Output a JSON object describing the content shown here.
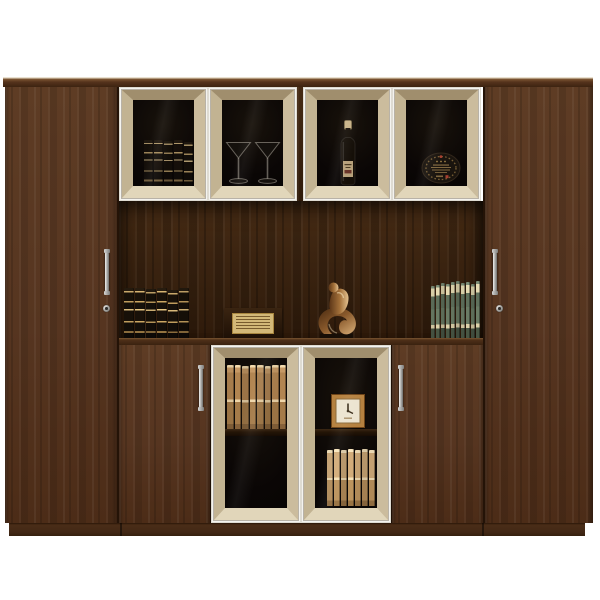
{
  "image": {
    "type": "furniture product photograph",
    "subject": "dark walnut office wall cabinet with champagne-framed glass display doors",
    "background": "#ffffff"
  },
  "colors": {
    "wood": "#573620",
    "wood_dark_interior": "#38220f",
    "frame_champagne": "#c9ba9b",
    "frame_white_edge": "#f4f3ef",
    "glass_black": "#070403",
    "plinth": "#432816",
    "handle_silver": "#c9c9c7",
    "bronze_figurine": "#8a5a2c",
    "clock_frame": "#b5813f",
    "gold_book_band": "#c9a86a",
    "green_book": "#5a6a56",
    "tan_book": "#a67c4c"
  },
  "cabinet": {
    "left_side_cabinet": {
      "title": "tall wooden cabinet door with silver handle and keyhole"
    },
    "right_side_cabinet": {
      "title": "tall wooden cabinet door with silver handle and keyhole"
    },
    "top_display_doors": [
      {
        "title": "glass door with gold-banded encyclopedias"
      },
      {
        "title": "glass door with two martini glasses"
      },
      {
        "title": "glass door with wine bottle"
      },
      {
        "title": "glass door with commemorative plate"
      }
    ],
    "open_shelf_items": [
      {
        "title": "set of gold-banded encyclopedias"
      },
      {
        "title": "framed certificate plaque"
      },
      {
        "title": "bronze abstract figurine"
      },
      {
        "title": "row of green paperback volumes"
      }
    ],
    "bottom_row": {
      "left_wood_door": {
        "title": "wooden door with silver handle"
      },
      "left_glass_door": {
        "title": "glass door with tan books on upper shelf"
      },
      "right_glass_door": {
        "title": "glass door with wooden clock and tan books"
      },
      "right_wood_door": {
        "title": "wooden door with silver handle"
      }
    }
  },
  "books": {
    "display_top_left": {
      "style": "encyclopedia",
      "count": 5,
      "book_width": 9,
      "heights": [
        46,
        46,
        45,
        46,
        44
      ]
    },
    "alcove_left": {
      "style": "encyclopedia",
      "count": 6,
      "book_width": 10,
      "heights": [
        50,
        50,
        49,
        50,
        48,
        50
      ]
    },
    "alcove_right": {
      "style": "green",
      "count": 10,
      "book_width": 4,
      "heights": [
        52,
        53,
        55,
        54,
        56,
        57,
        55,
        56,
        54,
        57
      ]
    },
    "cabinet_top_shelf": {
      "style": "tan",
      "count": 8,
      "book_width": 6.5,
      "heights": [
        64,
        64,
        63,
        64,
        64,
        63,
        64,
        64
      ]
    },
    "cabinet_bottom_shelf": {
      "style": "tanlight",
      "count": 7,
      "book_width": 6,
      "heights": [
        56,
        57,
        56,
        57,
        56,
        57,
        56
      ]
    }
  }
}
